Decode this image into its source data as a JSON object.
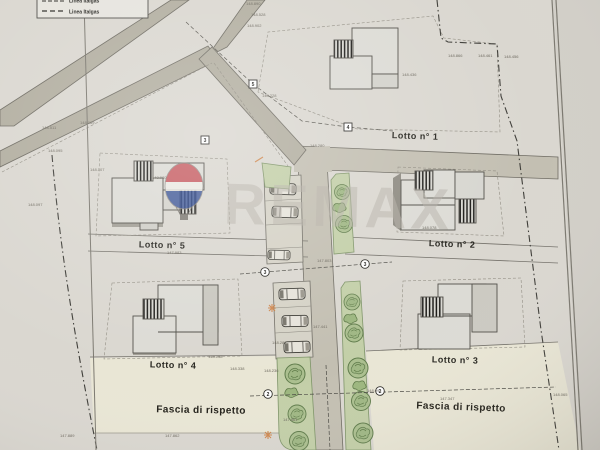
{
  "document": {
    "type": "site plan photo",
    "description": "lottization plan with five lots"
  },
  "legend": {
    "cropped_item": "Linea Italgas",
    "items": [
      "Linea Italgas"
    ]
  },
  "lots": [
    {
      "label": "Lotto n° 1"
    },
    {
      "label": "Lotto n° 5"
    },
    {
      "label": "Lotto n° 2"
    },
    {
      "label": "Lotto n° 4"
    },
    {
      "label": "Lotto n° 3"
    }
  ],
  "zones": [
    {
      "label": "Fascia di rispetto"
    },
    {
      "label": "Fascia di rispetto"
    }
  ],
  "watermark": {
    "brand": "REMAX"
  },
  "markers": {
    "boxed": [
      "5",
      "4",
      "3"
    ],
    "circled": [
      "3",
      "3",
      "2",
      "2"
    ]
  },
  "spot_elevations": [
    {
      "x": 42,
      "y": 129,
      "v": "148.511"
    },
    {
      "x": 48,
      "y": 152,
      "v": "148.095"
    },
    {
      "x": 90,
      "y": 171,
      "v": "148.107"
    },
    {
      "x": 28,
      "y": 206,
      "v": "148.097"
    },
    {
      "x": 80,
      "y": 124,
      "v": "148.069"
    },
    {
      "x": 246,
      "y": 5,
      "v": "148.890"
    },
    {
      "x": 251,
      "y": 16,
      "v": "148.528"
    },
    {
      "x": 247,
      "y": 27,
      "v": "148.902"
    },
    {
      "x": 262,
      "y": 97,
      "v": "148.228"
    },
    {
      "x": 310,
      "y": 147,
      "v": "148.280"
    },
    {
      "x": 448,
      "y": 57,
      "v": "148.866"
    },
    {
      "x": 478,
      "y": 57,
      "v": "148.461"
    },
    {
      "x": 504,
      "y": 58,
      "v": "148.456"
    },
    {
      "x": 402,
      "y": 76,
      "v": "148.436"
    },
    {
      "x": 422,
      "y": 229,
      "v": "148.078"
    },
    {
      "x": 152,
      "y": 179,
      "v": "148.080"
    },
    {
      "x": 167,
      "y": 254,
      "v": "147.983"
    },
    {
      "x": 313,
      "y": 328,
      "v": "147.441"
    },
    {
      "x": 317,
      "y": 262,
      "v": "147.803"
    },
    {
      "x": 272,
      "y": 344,
      "v": "148.287"
    },
    {
      "x": 264,
      "y": 372,
      "v": "148.236"
    },
    {
      "x": 367,
      "y": 392,
      "v": "148.094"
    },
    {
      "x": 283,
      "y": 421,
      "v": "147.861"
    },
    {
      "x": 440,
      "y": 400,
      "v": "147.347"
    },
    {
      "x": 553,
      "y": 396,
      "v": "148.065"
    },
    {
      "x": 230,
      "y": 370,
      "v": "148.338"
    },
    {
      "x": 208,
      "y": 358,
      "v": "148.158"
    },
    {
      "x": 60,
      "y": 437,
      "v": "147.889"
    },
    {
      "x": 165,
      "y": 437,
      "v": "147.862"
    }
  ],
  "colors": {
    "paper": "#dad7d0",
    "road_main": "#b2aea0",
    "road_secondary": "#c3bfb2",
    "parking": "#d5d2c6",
    "green_area": "#c3cfa8",
    "tree": "#a8bd8c",
    "fascia": "#e9e6d5",
    "house": "#dcdbd5",
    "house_shadow": "#8e8b82",
    "boundary": "#3e3d38",
    "watermark_gray": "#b6b1a8",
    "balloon_red": "#c2424a",
    "balloon_blue": "#2a4791",
    "accent_orange": "#cc7a3a",
    "text_dark": "#26251f"
  }
}
